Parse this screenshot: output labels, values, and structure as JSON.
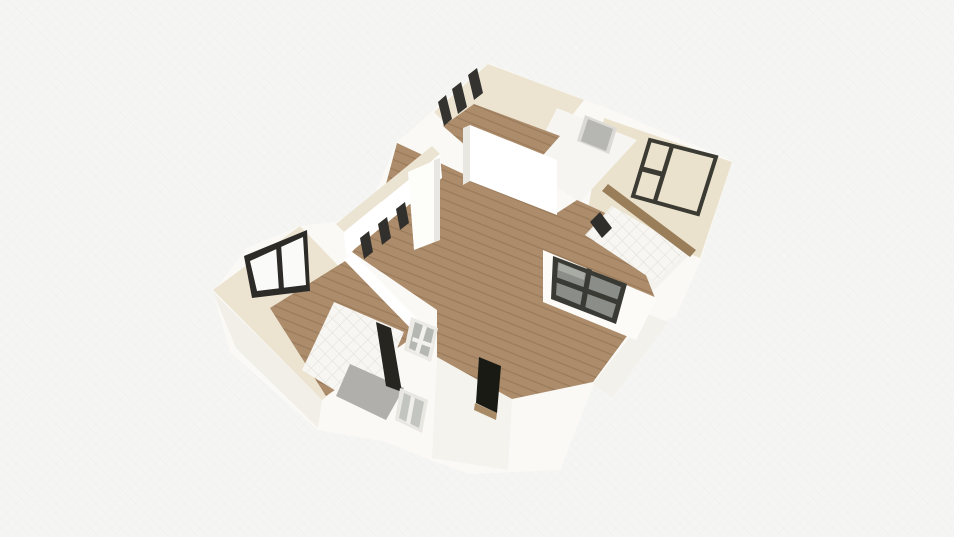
{
  "view": {
    "tool": "3d-floorplan-render",
    "width": 954,
    "height": 537,
    "background": "#f5f5f3"
  },
  "palette": {
    "building_mass": "#faf9f6",
    "wall_white": "#ffffff",
    "wall_shade": "#e9e7e1",
    "cream_top": "#ece4d1",
    "cream_floor": "#eae2cd",
    "wood_base": "#ac8c6a",
    "wood_line": "#9a7b5c",
    "wood_strip": "#9a7e5a",
    "tile_base": "#f7f6f2",
    "tile_line": "#e0ddd5",
    "frame_dark": "#34332f",
    "glass_gray": "#8b8d88",
    "glass_light": "#c2c5c0",
    "door_black": "#1a1a15",
    "door_gray": "#b6b6b2",
    "shower_gray": "#b0afab",
    "opening_dark": "#26251f",
    "sill_tan": "#a98a66",
    "front_shade": "#f2efe9"
  },
  "scene": {
    "polygons": [
      {
        "name": "building-mass",
        "fill": "#faf9f6",
        "points": "488,63 584,100 602,106 732,161 700,262 676,316 648,330 593,386 560,470 470,474 430,460 386,442 318,430 230,352 213,292 247,248 300,226 336,222 372,200 397,142 434,110"
      },
      {
        "name": "front-wall-left-shade",
        "fill": "#f2efe9",
        "points": "213,292 322,400 318,428 236,348"
      },
      {
        "name": "front-wall-entry-shade",
        "fill": "#f5f3ee",
        "points": "437,357 512,399 508,470 432,458"
      },
      {
        "name": "front-wall-right-shade",
        "fill": "#f3f1eb",
        "points": "593,384 648,314 668,322 612,398"
      },
      {
        "name": "left-bedroom-wall-plate",
        "fill": "#ece4d1",
        "points": "300,226 213,290 322,400 404,334"
      },
      {
        "name": "top-room-wall-plate",
        "fill": "#ece4d1",
        "points": "488,64 584,100 512,192 434,112"
      },
      {
        "name": "right-bedroom-floor",
        "fill": "#eae2cd",
        "points": "604,118 732,162 700,258 588,210"
      },
      {
        "name": "hallway-floor",
        "fill": "#f6f5f1",
        "points": "557,108 637,140 580,202 527,168"
      },
      {
        "name": "right-bathroom-plate",
        "fill": "#f4f2ec",
        "points": "585,212 692,252 652,292 558,250"
      },
      {
        "name": "bath-nw-wall-band",
        "fill": "#fbfaf7",
        "points": "326,292 410,326 404,336 320,302"
      },
      {
        "name": "left-bedroom-wood-floor",
        "fill": "wood",
        "points": "270,308 350,258 424,330 326,396"
      },
      {
        "name": "top-room-wood-floor",
        "fill": "wood",
        "points": "474,104 560,136 514,188 443,126"
      },
      {
        "name": "living-room-wood-floor",
        "fill": "wood",
        "points": "397,143 470,177 557,213 577,200 625,222 655,298 593,382 512,399 437,357 437,310 352,252 375,225"
      },
      {
        "name": "bathroom-tile-floor",
        "fill": "tile",
        "points": "334,302 404,332 370,412 302,370"
      },
      {
        "name": "shower-gray-floor",
        "fill": "#b0afab",
        "points": "350,364 404,388 386,420 336,396"
      },
      {
        "name": "bathroom-door-opening",
        "fill": "#26251f",
        "points": "376,322 391,328 402,392 386,386"
      },
      {
        "name": "right-bathroom-tile-floor",
        "fill": "tile",
        "points": "612,206 688,250 656,282 585,235"
      },
      {
        "name": "right-bathroom-wall-slat",
        "fill": "#2f2e2a",
        "points": "590,222 600,212 612,228 602,238"
      },
      {
        "name": "right-bedroom-wood-strip",
        "fill": "#9a7e5a",
        "points": "608,184 696,250 690,257 602,191"
      },
      {
        "name": "left-bedroom-ne-wall",
        "fill": "#ffffff",
        "points": "352,252 428,330 420,338 344,260"
      },
      {
        "name": "nw-wall-top-band",
        "fill": "#ece4d2",
        "points": "336,224 432,146 440,154 344,232"
      },
      {
        "name": "nw-wall-white-face",
        "fill": "#ffffff",
        "points": "344,232 440,154 442,178 346,256"
      },
      {
        "name": "nw-window-slat-1",
        "fill": "#31302c",
        "points": "360,238 369,231 373,252 364,259"
      },
      {
        "name": "nw-window-slat-2",
        "fill": "#31302c",
        "points": "378,224 387,217 391,238 382,245"
      },
      {
        "name": "nw-window-slat-3",
        "fill": "#31302c",
        "points": "396,209 405,202 409,223 400,230"
      },
      {
        "name": "nw-window-slat-4",
        "fill": "#31302c",
        "points": "414,195 423,188 427,209 418,216"
      },
      {
        "name": "wall-pillar",
        "fill": "#fdfdfa",
        "points": "408,172 440,158 440,240 414,250"
      },
      {
        "name": "wall-pillar-shade",
        "fill": "#e9e7e1",
        "points": "434,160 440,158 440,240 434,242"
      },
      {
        "name": "center-wall-shade-edge",
        "fill": "#e9e7e1",
        "points": "463,128 470,125 470,181 463,185"
      },
      {
        "name": "center-tall-white-wall",
        "fill": "#ffffff",
        "points": "470,125 557,160 557,215 470,181"
      },
      {
        "name": "top-room-window-slat-1",
        "fill": "#34332f",
        "points": "468,75 477,68 483,93 474,100"
      },
      {
        "name": "top-room-window-slat-2",
        "fill": "#34332f",
        "points": "452,89 461,82 467,107 458,114"
      },
      {
        "name": "top-room-window-slat-3",
        "fill": "#34332f",
        "points": "438,102 446,95 452,119 444,126"
      },
      {
        "name": "left-window-frame",
        "fill": "#2c2b28",
        "points": "244,256 307,230 310,291 252,298"
      },
      {
        "name": "left-window-glass",
        "fill": "#fafaf8",
        "points": "250,261 303,237 306,285 257,291"
      },
      {
        "name": "left-window-divider",
        "fill": "#2c2b28",
        "points": "276,246 281,244 284,289 279,291"
      },
      {
        "name": "hall-door-frame",
        "fill": "#dcdad5",
        "points": "585,115 617,128 609,154 577,141"
      },
      {
        "name": "hall-door-gray",
        "fill": "#b6b6b2",
        "points": "588,119 613,129 606,151 581,141"
      },
      {
        "name": "right-window-frame-outline",
        "fill": "none",
        "stroke": "#3b3a33",
        "stroke_width": 4,
        "points": "650,140 716,157 698,214 633,196"
      },
      {
        "name": "right-window-mullion-v",
        "fill": "#3b3a33",
        "points": "670,145 674,147 657,202 653,200"
      },
      {
        "name": "right-window-mullion-h",
        "fill": "#3b3a33",
        "points": "641,166 664,172 663,177 640,171"
      },
      {
        "name": "se-wall-white-face",
        "fill": "#fcfbf8",
        "points": "543,250 657,298 636,340 543,302"
      },
      {
        "name": "se-window-frame",
        "fill": "#3a3a35",
        "points": "553,256 627,284 616,324 551,299"
      },
      {
        "name": "se-window-glass",
        "fill": "#8b8d88",
        "points": "558,262 621,287 612,318 556,295"
      },
      {
        "name": "se-window-sheen",
        "fill": "#a9aba5",
        "points": "559,263 585,273 584,280 558,270"
      },
      {
        "name": "se-window-mullion-v",
        "fill": "#3a3a35",
        "points": "587,268 592,270 585,309 580,307"
      },
      {
        "name": "se-window-mullion-h",
        "fill": "#3a3a35",
        "points": "556,277 619,300 618,305 555,282"
      },
      {
        "name": "glazed-door-frame",
        "fill": "#eceae5",
        "points": "411,317 438,328 431,362 404,350"
      },
      {
        "name": "glazed-door-glass",
        "fill": "#b4b7b2",
        "points": "415,322 434,330 428,357 409,348"
      },
      {
        "name": "glazed-door-mullion-v",
        "fill": "#f2f1ed",
        "points": "423,325 427,327 419,354 415,352"
      },
      {
        "name": "glazed-door-mullion-h",
        "fill": "#f2f1ed",
        "points": "413,337 433,344 432,348 412,341"
      },
      {
        "name": "entry-black-door",
        "fill": "#1a1a15",
        "points": "479,357 501,366 497,413 476,403"
      },
      {
        "name": "entry-door-sill",
        "fill": "#a98a66",
        "points": "475,403 497,413 496,420 474,410"
      },
      {
        "name": "front-window-frame",
        "fill": "#e9e7e2",
        "points": "400,388 428,400 422,433 395,420"
      },
      {
        "name": "front-window-glass",
        "fill": "#c2c5c0",
        "points": "404,393 424,402 419,428 399,418"
      },
      {
        "name": "front-window-mullion",
        "fill": "#f0efeb",
        "points": "411,396 415,398 410,425 406,423"
      }
    ]
  }
}
